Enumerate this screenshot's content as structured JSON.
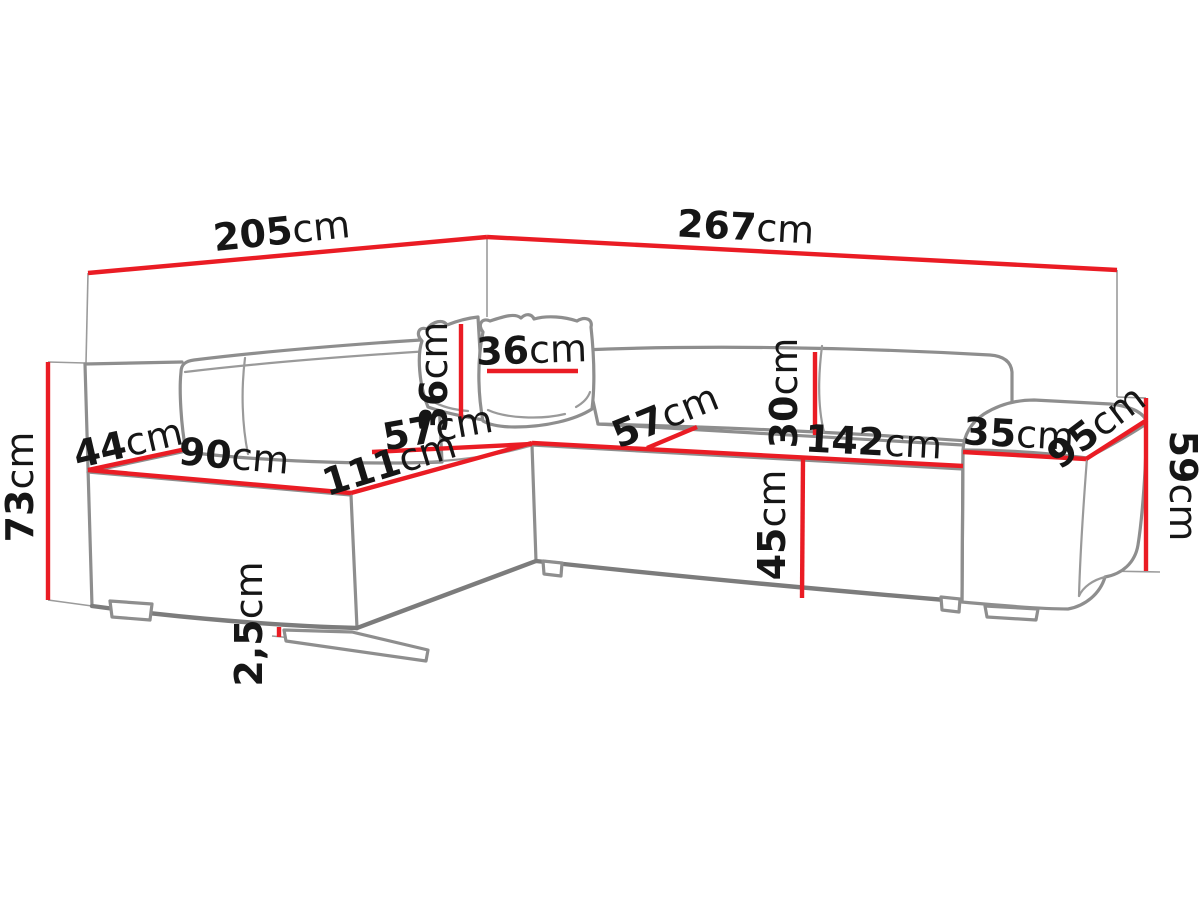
{
  "figure": {
    "type": "furniture dimension diagram",
    "subject": "corner sofa with chaise, two pillows and side armrest",
    "unit_system": "cm",
    "background_color": "#ffffff",
    "dimension_line_color": "#ea1c24",
    "outline_color": "#8e8e8e",
    "label_color": "#161616"
  },
  "dimensions": [
    {
      "id": "total-width-left",
      "value": "205",
      "unit": "cm"
    },
    {
      "id": "total-width-right",
      "value": "267",
      "unit": "cm"
    },
    {
      "id": "total-height",
      "value": "73",
      "unit": "cm"
    },
    {
      "id": "left-end-width",
      "value": "44",
      "unit": "cm"
    },
    {
      "id": "left-module-width",
      "value": "90",
      "unit": "cm"
    },
    {
      "id": "chaise-edge-length",
      "value": "111",
      "unit": "cm"
    },
    {
      "id": "seat-depth-left",
      "value": "57",
      "unit": "cm"
    },
    {
      "id": "pillow-height",
      "value": "36",
      "unit": "cm"
    },
    {
      "id": "pillow-width",
      "value": "36",
      "unit": "cm"
    },
    {
      "id": "seat-depth-right",
      "value": "57",
      "unit": "cm"
    },
    {
      "id": "backrest-height",
      "value": "30",
      "unit": "cm"
    },
    {
      "id": "seat-front-width",
      "value": "142",
      "unit": "cm"
    },
    {
      "id": "seat-height",
      "value": "45",
      "unit": "cm"
    },
    {
      "id": "armrest-width",
      "value": "35",
      "unit": "cm"
    },
    {
      "id": "armrest-depth",
      "value": "95",
      "unit": "cm"
    },
    {
      "id": "armrest-height",
      "value": "59",
      "unit": "cm"
    },
    {
      "id": "foot-height",
      "value": "2,5",
      "unit": "cm"
    }
  ]
}
